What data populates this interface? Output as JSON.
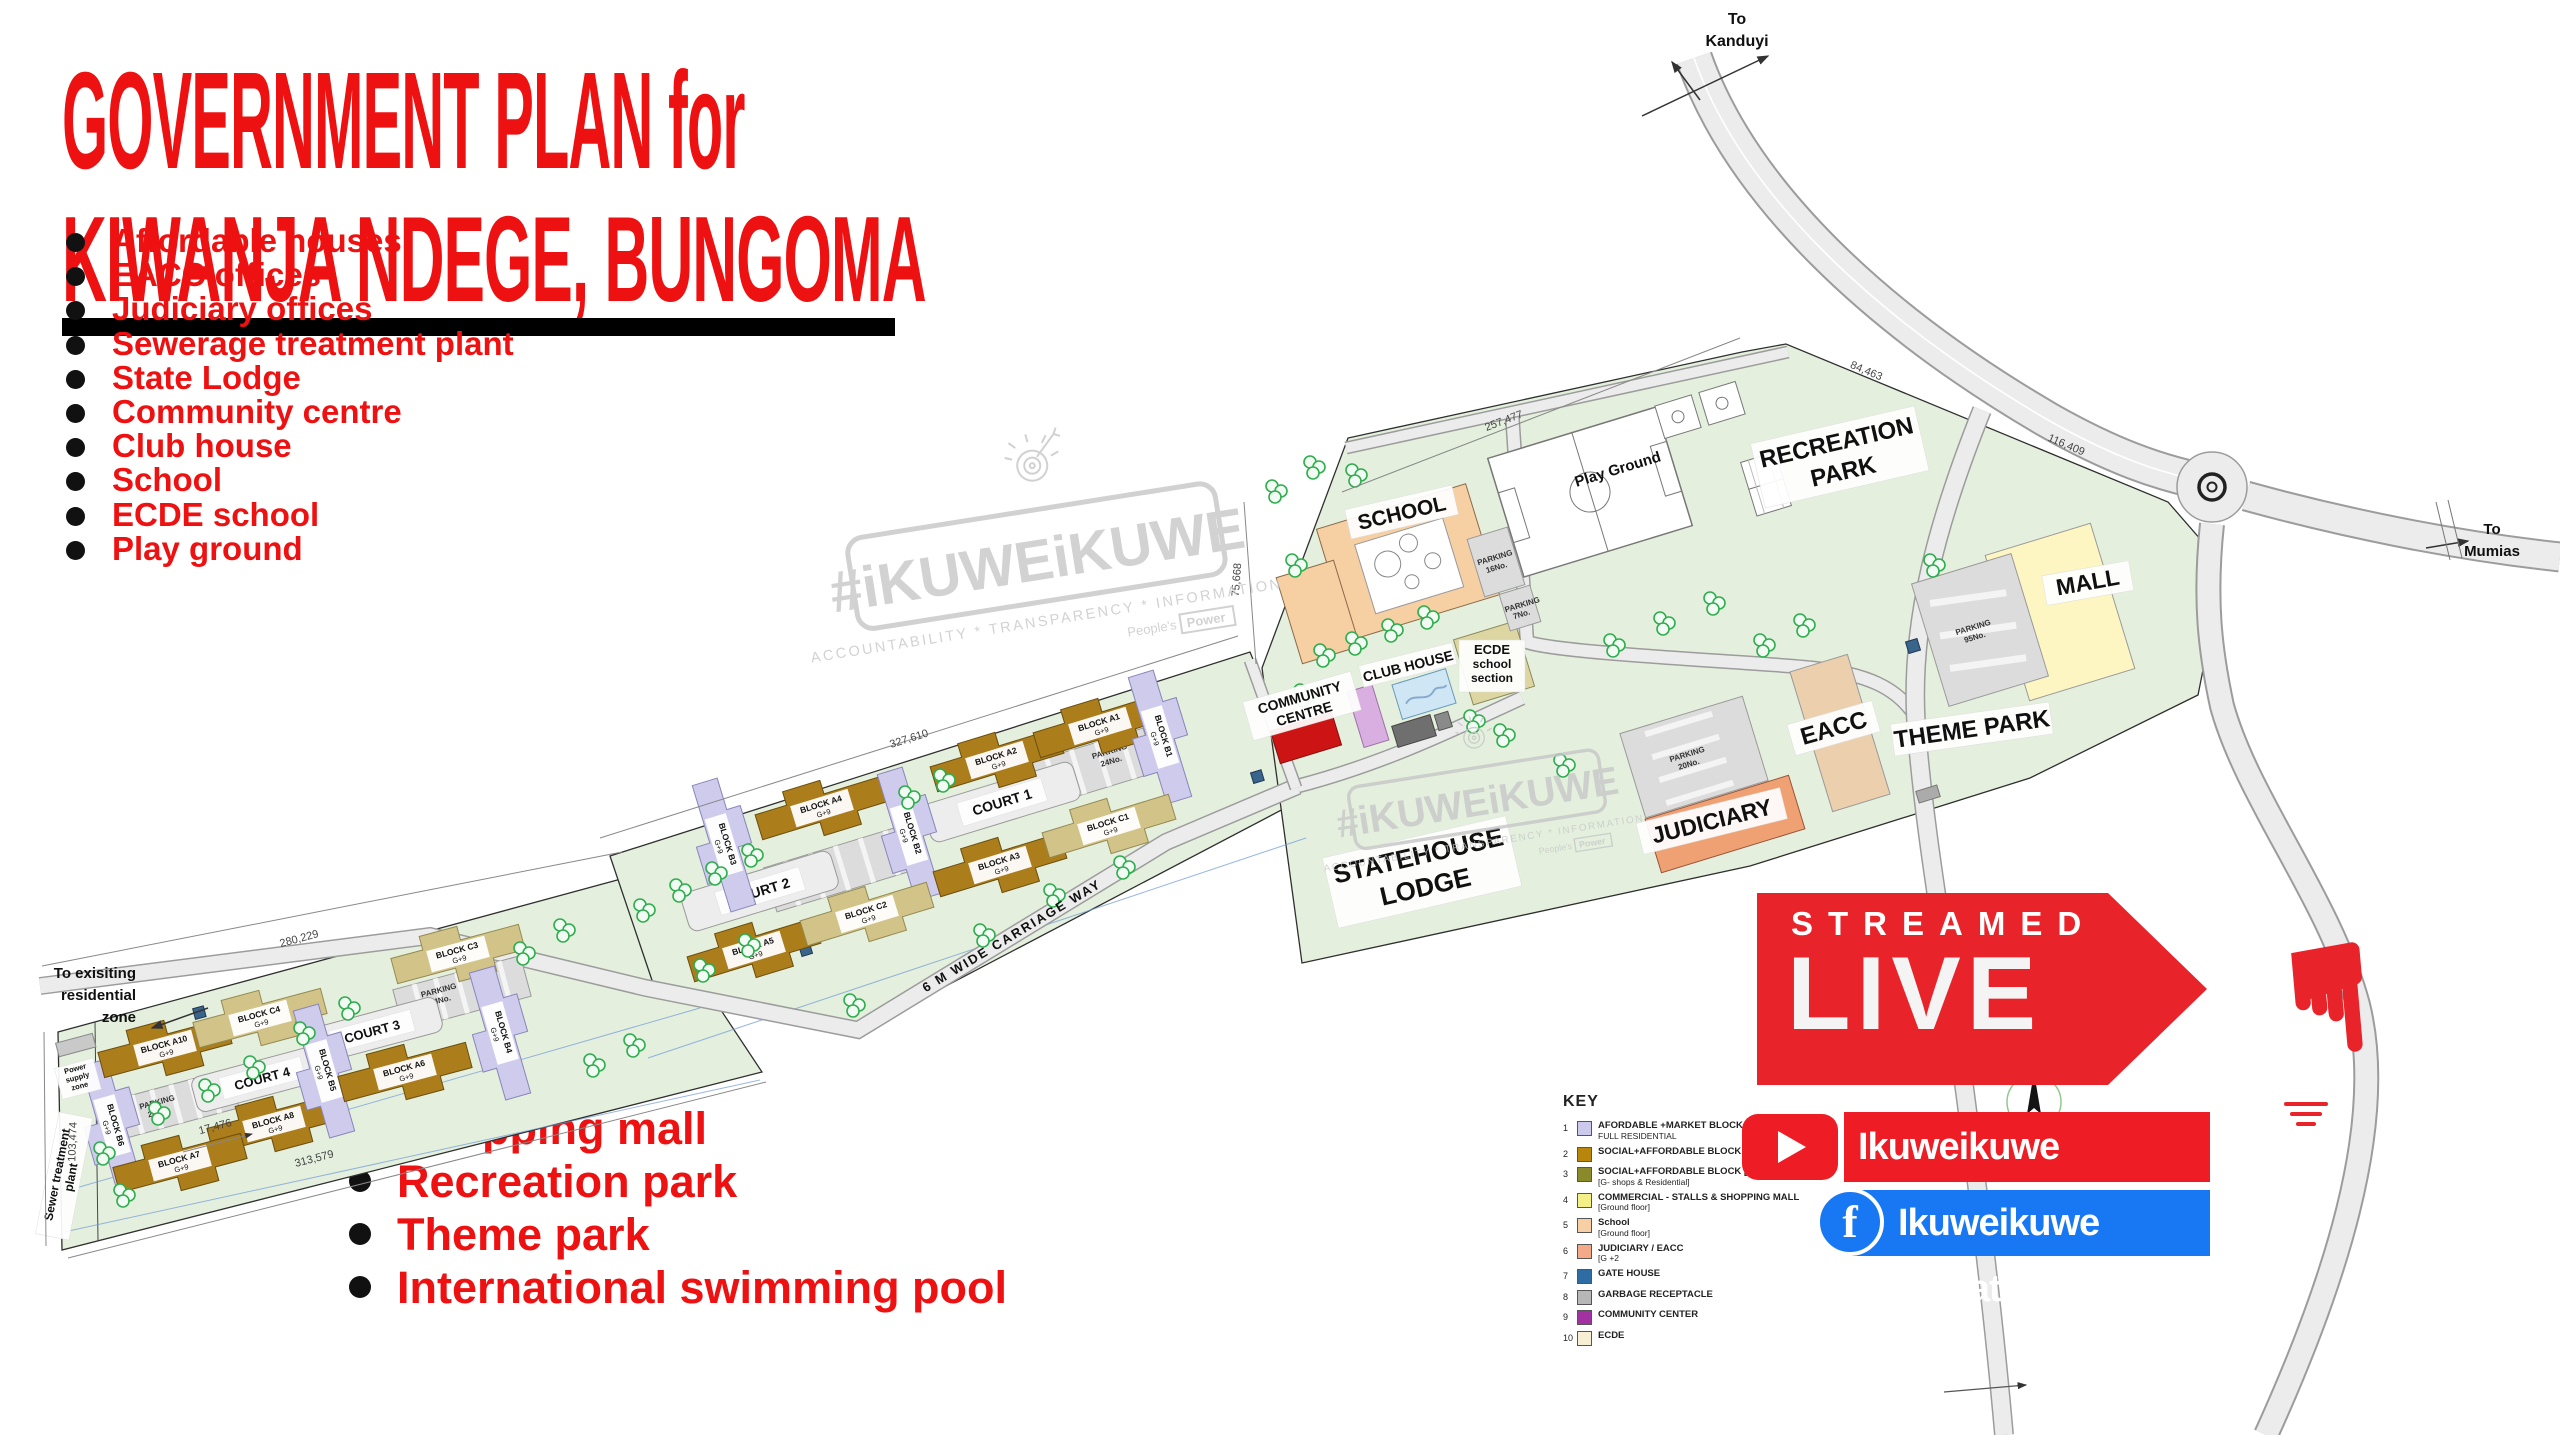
{
  "title": {
    "line1": "GOVERNMENT PLAN for",
    "line2": "KIWANJA NDEGE, BUNGOMA"
  },
  "features_top": [
    "Affordable houses",
    "EACC offices",
    "Judiciary offices",
    "Sewerage treatment plant",
    "State Lodge",
    "Community centre",
    "Club house",
    "School",
    "ECDE school",
    "Play ground"
  ],
  "features_bottom": [
    "Shopping mall",
    "Recreation park",
    "Theme park",
    "International swimming pool"
  ],
  "badge": {
    "streamed": "STREAMED",
    "live": "LIVE"
  },
  "social": {
    "youtube": "Ikuweikuwe Updates",
    "facebook": "Ikuweikuwe Updates",
    "facebook_f": "f"
  },
  "watermark": {
    "logo": "#iKUWEiKUWE",
    "tagline": "ACCOUNTABILITY * TRANSPARENCY * INFORMATION",
    "peoples": "People's",
    "power": "Power"
  },
  "key": {
    "title": "KEY",
    "items": [
      {
        "num": "1",
        "color": "#cdc9ec",
        "line1": "AFORDABLE +MARKET BLOCK B",
        "line2": "FULL RESIDENTIAL"
      },
      {
        "num": "2",
        "color": "#b8860b",
        "line1": "SOCIAL+AFFORDABLE BLOCK [A]",
        "line2": ""
      },
      {
        "num": "3",
        "color": "#8a8a2a",
        "line1": "SOCIAL+AFFORDABLE BLOCK [C]",
        "line2": "[G- shops & Residential]"
      },
      {
        "num": "4",
        "color": "#f3f087",
        "line1": "COMMERCIAL - STALLS & SHOPPING MALL",
        "line2": "[Ground floor]"
      },
      {
        "num": "5",
        "color": "#f6d0a4",
        "line1": "School",
        "line2": "[Ground floor]"
      },
      {
        "num": "6",
        "color": "#f4a988",
        "line1": "JUDICIARY / EACC",
        "line2": "[G +2"
      },
      {
        "num": "7",
        "color": "#2e6da4",
        "line1": "GATE HOUSE",
        "line2": ""
      },
      {
        "num": "8",
        "color": "#b7b7b7",
        "line1": "GARBAGE RECEPTACLE",
        "line2": ""
      },
      {
        "num": "9",
        "color": "#a232a2",
        "line1": "COMMUNITY CENTER",
        "line2": ""
      },
      {
        "num": "10",
        "color": "#f7eed3",
        "line1": "ECDE",
        "line2": ""
      }
    ]
  },
  "map": {
    "roads": {
      "to_kanduyi_l1": "To",
      "to_kanduyi_l2": "Kanduyi",
      "to_mumias_l1": "To",
      "to_mumias_l2": "Mumias",
      "residential_l1": "To exisiting",
      "residential_l2": "residential",
      "residential_l3": "zone",
      "carriage_way": "6 M WIDE CARRIAGE WAY"
    },
    "areas": {
      "school": "SCHOOL",
      "play_ground": "Play Ground",
      "recreation_l1": "RECREATION",
      "recreation_l2": "PARK",
      "mall": "MALL",
      "theme_park": "THEME PARK",
      "eacc": "EACC",
      "judiciary": "JUDICIARY",
      "statehouse_l1": "STATEHOUSE",
      "statehouse_l2": "LODGE",
      "community_l1": "COMMUNITY",
      "community_l2": "CENTRE",
      "club_house": "CLUB HOUSE",
      "ecde_l1": "ECDE",
      "ecde_l2": "school",
      "ecde_l3": "section",
      "court1": "COURT 1",
      "court2": "COURT 2",
      "court3": "COURT 3",
      "court4": "COURT 4",
      "sewer_l1": "Sewer treatment",
      "sewer_l2": "plant",
      "power_l1": "Power",
      "power_l2": "supply",
      "power_l3": "zone",
      "compass_n": "N"
    },
    "parking": {
      "label": "PARKING",
      "c24": "24No.",
      "c16": "16No.",
      "c7": "7No.",
      "c20": "20No.",
      "c95": "95No."
    },
    "dimensions": {
      "d_257": "257,477",
      "d_75": "75,668",
      "d_327": "327,610",
      "d_280": "280,229",
      "d_103": "103,474",
      "d_313": "313,579",
      "d_17": "17,476",
      "d_84": "84,463",
      "d_116": "116,409"
    },
    "blocks": [
      {
        "name": "BLOCK B6",
        "floors": "G+9"
      },
      {
        "name": "BLOCK A10",
        "floors": "G+9"
      },
      {
        "name": "BLOCK C4",
        "floors": "G+9"
      },
      {
        "name": "BLOCK A8",
        "floors": "G+9"
      },
      {
        "name": "BLOCK A7",
        "floors": "G+9"
      },
      {
        "name": "BLOCK B5",
        "floors": "G+9"
      },
      {
        "name": "BLOCK A6",
        "floors": "G+9"
      },
      {
        "name": "BLOCK C3",
        "floors": "G+9"
      },
      {
        "name": "BLOCK B4",
        "floors": "G+9"
      },
      {
        "name": "BLOCK B3",
        "floors": "G+9"
      },
      {
        "name": "BLOCK A4",
        "floors": "G+9"
      },
      {
        "name": "BLOCK B2",
        "floors": "G+9"
      },
      {
        "name": "BLOCK A2",
        "floors": "G+9"
      },
      {
        "name": "BLOCK A1",
        "floors": "G+9"
      },
      {
        "name": "BLOCK B1",
        "floors": "G+9"
      },
      {
        "name": "BLOCK A5",
        "floors": "G+9"
      },
      {
        "name": "BLOCK C2",
        "floors": "G+9"
      },
      {
        "name": "BLOCK A3",
        "floors": "G+9"
      },
      {
        "name": "BLOCK C1",
        "floors": "G+9"
      }
    ]
  }
}
